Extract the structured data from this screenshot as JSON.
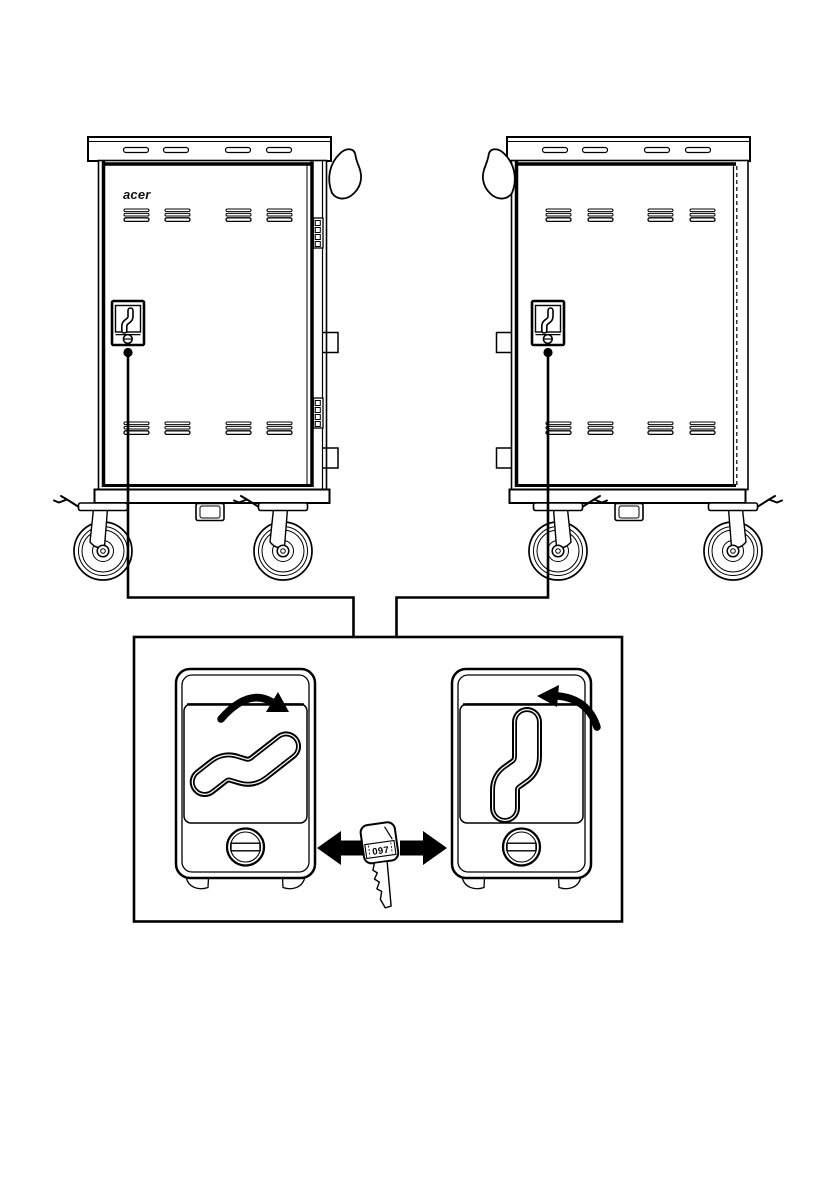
{
  "page": {
    "background": "#ffffff",
    "line_color": "#000000",
    "arrow_fill": "#000000"
  },
  "left_cart": {
    "brand_logo": "acer"
  },
  "detail_view": {
    "key_label": "097"
  },
  "icons": {
    "lock": "cart-door-lock",
    "keyhole": "round-keyhole-with-slot",
    "key": "flat-key-with-number-tag",
    "rotate_open": "thick-curved-arrow-clockwise",
    "rotate_close": "thick-curved-arrow-counterclockwise",
    "swap_left": "solid-arrow-left",
    "swap_right": "solid-arrow-right",
    "caster": "swivel-caster-with-brake",
    "handle": "cart-push-handle"
  }
}
